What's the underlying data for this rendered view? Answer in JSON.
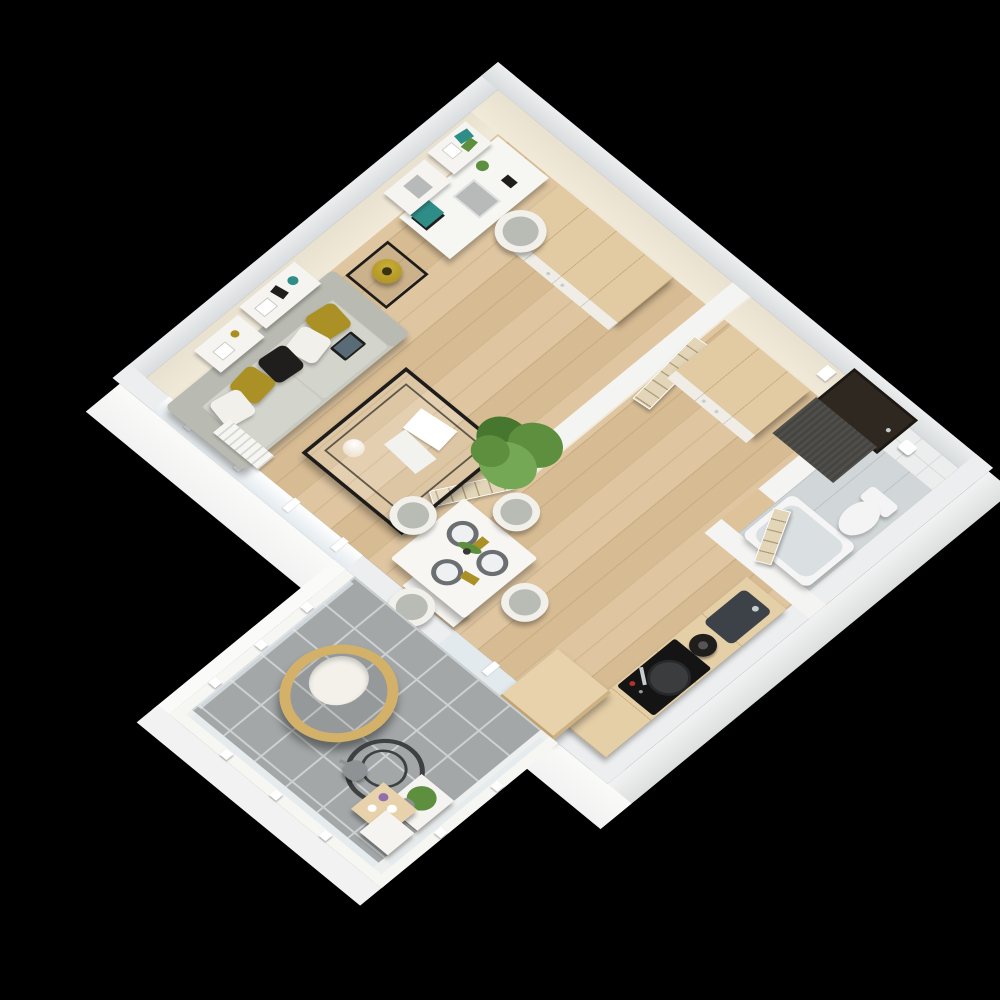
{
  "scene": {
    "type": "3d-floor-plan-render",
    "view": "isometric bird's-eye",
    "background": "black",
    "description": "Photorealistic 3D floor plan of a one-bedroom apartment with open living/dining room, hallway, bathroom, kitchenette and a tiled balcony"
  },
  "colors": {
    "bg": "#000000",
    "wall_top": "#d9dcde",
    "wall_top_light": "#eceeef",
    "wall_white": "#f4f4f2",
    "apron": "#f1f2f1",
    "apron_bright": "#fafaf9",
    "apron_shade": "#dddfdf",
    "face_cream": "#f1ead9",
    "face_cream2": "#e9e1cf",
    "tile_wall": "#eceeee",
    "tile_grout": "#d6dadb",
    "wood_floor": "#ddc29a",
    "bath_floor": "#d1d6d8",
    "balcony_tile": "#a3a7a8",
    "balcony_grout": "#ced1d1",
    "slab": "#eef0ef",
    "wood_top": "#e2cba3",
    "wood_seam": "#c9ad7f",
    "cabinet_front": "#f0ede6",
    "counter_wood": "#e5cfa7",
    "island_wood": "#e7d2ab",
    "door_wood": "#e3d6b8",
    "door_dark": "#2f2821",
    "door_frame": "#1d1813",
    "mat": "#454440",
    "sofa": "#c8c9c0",
    "sofa_back": "#b9bab1",
    "sofa_seat": "#d3d4cb",
    "mustard": "#ab9125",
    "pillow_white": "#f1f0ea",
    "black_item": "#1f1e1c",
    "metal": "#1d1c1a",
    "gold": "#a98e20",
    "chrome": "#c7cccd",
    "plant": "#5d8f3f",
    "plant_dark": "#47762f",
    "plant_light": "#74a854",
    "teal": "#2f8d88",
    "laptop": "#b7bab9",
    "shelf_white": "#f5f4f0",
    "white_furn": "#f6f6f3",
    "table_white": "#f7f6f2",
    "placemat": "#6b6f71",
    "plate": "#eef0f1",
    "chair_shell": "#f1f0ea",
    "chair_seat": "#b9bbb5",
    "sink": "#3c4247",
    "cooktop": "#141414",
    "red": "#b03428",
    "tub": "#f4f5f4",
    "tub_inner": "#dadfe1",
    "toilet": "#f3f4f3",
    "radiator": "#f5f5f2",
    "tv": "#121212",
    "frost": "#e3eaee",
    "rattan": "#d3b169",
    "cushion": "#f3f1ea",
    "coil": "#3e4042",
    "gray_item": "#8e9294",
    "purple": "#8f6fae"
  },
  "rooms": {
    "living_dining": {
      "label": "Living and dining room",
      "floor": "light oak planks",
      "furniture": [
        "3-seat gray sofa with mustard, white and black pillows",
        "tablet on sofa seat",
        "two white wall shelves with frames, teal vase and decor",
        "white desk with chair, laptop, books and plant",
        "floating desk shelves with books",
        "black metal side table with brass lamp",
        "black metal coffee table with glass top, magazines and glass sphere",
        "white media bench with TV",
        "radiator under window",
        "potted palm plant",
        "white square dining table with three place settings",
        "four white dining chairs"
      ]
    },
    "hallway": {
      "label": "Hallway",
      "floor": "light oak planks",
      "furniture": [
        "four-door white wardrobe with wooden top",
        "two-door white wardrobe with wooden top",
        "dark entrance door",
        "dark gray doormat",
        "white intercom panel",
        "open interior doors"
      ]
    },
    "bathroom": {
      "label": "Bathroom",
      "floor": "gray tile planks",
      "furniture": [
        "bathtub with chrome faucet",
        "wall-hung toilet",
        "toilet paper holder",
        "white tiled wall",
        "wooden door opening inward"
      ]
    },
    "kitchen": {
      "label": "Kitchenette",
      "floor": "light oak planks",
      "furniture": [
        "wooden counter along wall",
        "dark undermount sink with faucet",
        "black kettle",
        "black cooktop with pan and red knob",
        "freestanding wooden cabinet island"
      ]
    },
    "balcony": {
      "label": "Balcony",
      "floor": "gray square tiles",
      "furniture": [
        "hanging rattan egg chair with white cushion",
        "dark metal coil chair stand",
        "tiered plant stand with green plant, purple candle, vases and watering can",
        "gray watering can",
        "white railing with frosted glass panels and posts"
      ]
    }
  },
  "counts": {
    "dining_chairs": 4,
    "place_settings": 3,
    "sofa_pillows": 5,
    "wardrobes": 2,
    "interior_doors": 3,
    "wall_shelves": 4,
    "railing_posts": 8
  }
}
